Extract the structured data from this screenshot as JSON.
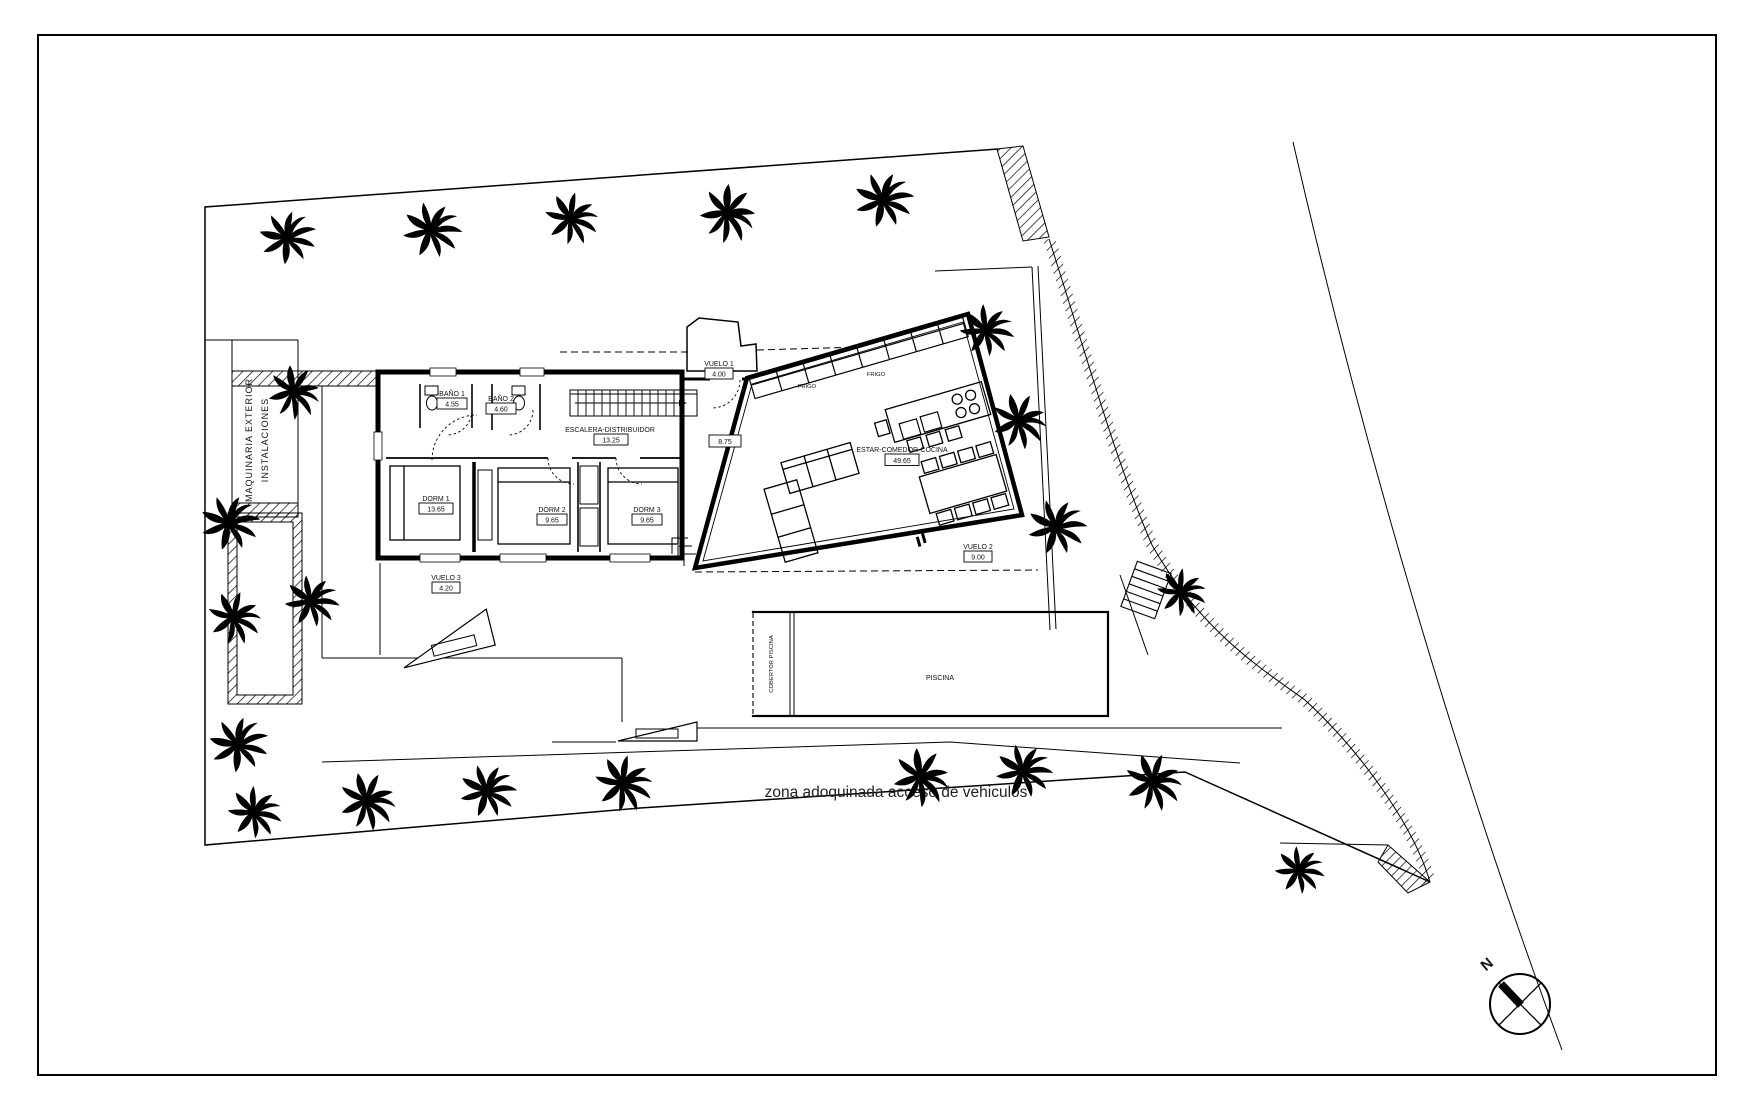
{
  "site": {
    "paved_zone_label": "zona adoquinada acceso de vehiculos",
    "machinery_line1": "MAQUINARIA EXTERIOR",
    "machinery_line2": "INSTALACIONES",
    "compass_north": "N"
  },
  "rooms": {
    "bano1": {
      "name": "BAÑO 1",
      "area": "4.55"
    },
    "bano2": {
      "name": "BAÑO 2",
      "area": "4.60"
    },
    "escalera": {
      "name": "ESCALERA-DISTRIBUIDOR",
      "area": "13.25"
    },
    "dorm1": {
      "name": "DORM 1",
      "area": "13.65"
    },
    "dorm2": {
      "name": "DORM 2",
      "area": "9.65"
    },
    "dorm3": {
      "name": "DORM 3",
      "area": "9.65"
    },
    "estar": {
      "name": "ESTAR-COMEDOR-COCINA",
      "area": "49.65"
    },
    "hall": {
      "area": "8.75"
    },
    "vuelo1": {
      "name": "VUELO 1",
      "area": "4.00"
    },
    "vuelo2": {
      "name": "VUELO 2",
      "area": "9.00"
    },
    "vuelo3": {
      "name": "VUELO 3",
      "area": "4.20"
    },
    "piscina": {
      "name": "PISCINA"
    },
    "cobertor": {
      "name": "COBERTOR PISCINA"
    },
    "frigo": {
      "name": "FRIGO"
    }
  }
}
